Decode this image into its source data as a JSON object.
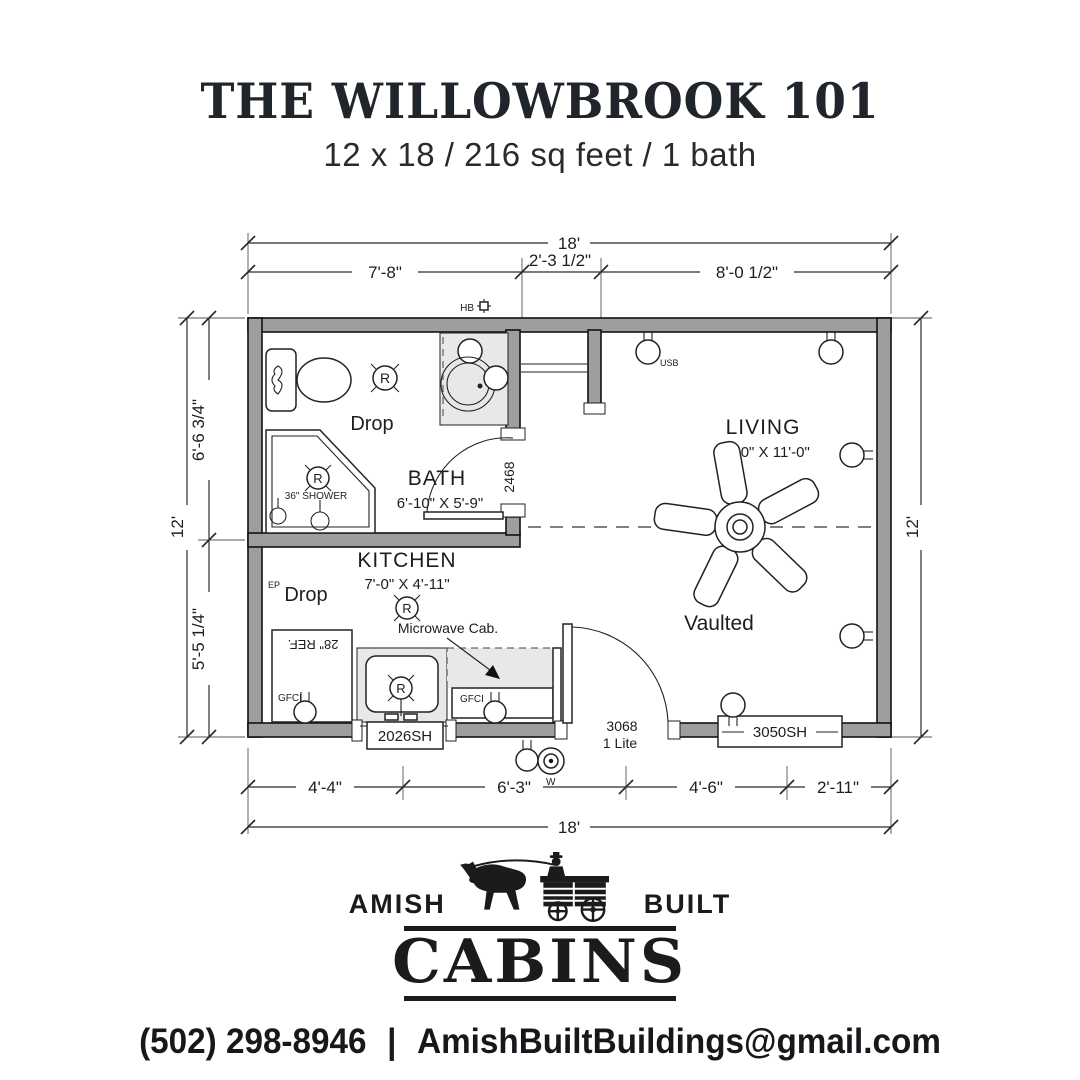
{
  "colors": {
    "wall": "#9e9e9e",
    "fixture": "#e8e8e8",
    "ink": "#1c1c1c",
    "dim": "#2b2b2b"
  },
  "header": {
    "title": "THE WILLOWBROOK 101",
    "subtitle": "12 x 18 / 216 sq feet / 1 bath"
  },
  "dims": {
    "top_total": "18'",
    "top_left": "7'-8\"",
    "top_mid": "2'-3 1/2\"",
    "top_right": "8'-0 1/2\"",
    "left_total": "12'",
    "left_upper": "6'-6 3/4\"",
    "left_lower": "5'-5 1/4\"",
    "right_total": "12'",
    "bottom_1": "4'-4\"",
    "bottom_2": "6'-3\"",
    "bottom_3": "4'-6\"",
    "bottom_4": "2'-11\"",
    "bottom_total": "18'"
  },
  "rooms": {
    "bath_name": "BATH",
    "bath_size": "6'-10\" X 5'-9\"",
    "kitchen_name": "KITCHEN",
    "kitchen_size": "7'-0\" X 4'-11\"",
    "living_name": "LIVING",
    "living_size": "10'-0\" X 11'-0\"",
    "living_note": "Vaulted"
  },
  "labels": {
    "drop": "Drop",
    "shower": "36\" SHOWER",
    "fridge": "28\" REF.",
    "microwave": "Microwave Cab.",
    "gfci": "GFCI",
    "hose_bib": "HB",
    "usb": "USB",
    "ep": "EP",
    "wp": "W",
    "bath_door": "2468",
    "entry_door": "3068",
    "entry_door_lite": "1 Lite",
    "kitchen_window": "2026SH",
    "living_window": "3050SH",
    "recessed": "R"
  },
  "logo": {
    "amish": "AMISH",
    "built": "BUILT",
    "cabins": "CABINS"
  },
  "contact": {
    "phone": "(502) 298-8946",
    "divider": "|",
    "email": "AmishBuiltBuildings@gmail.com"
  }
}
